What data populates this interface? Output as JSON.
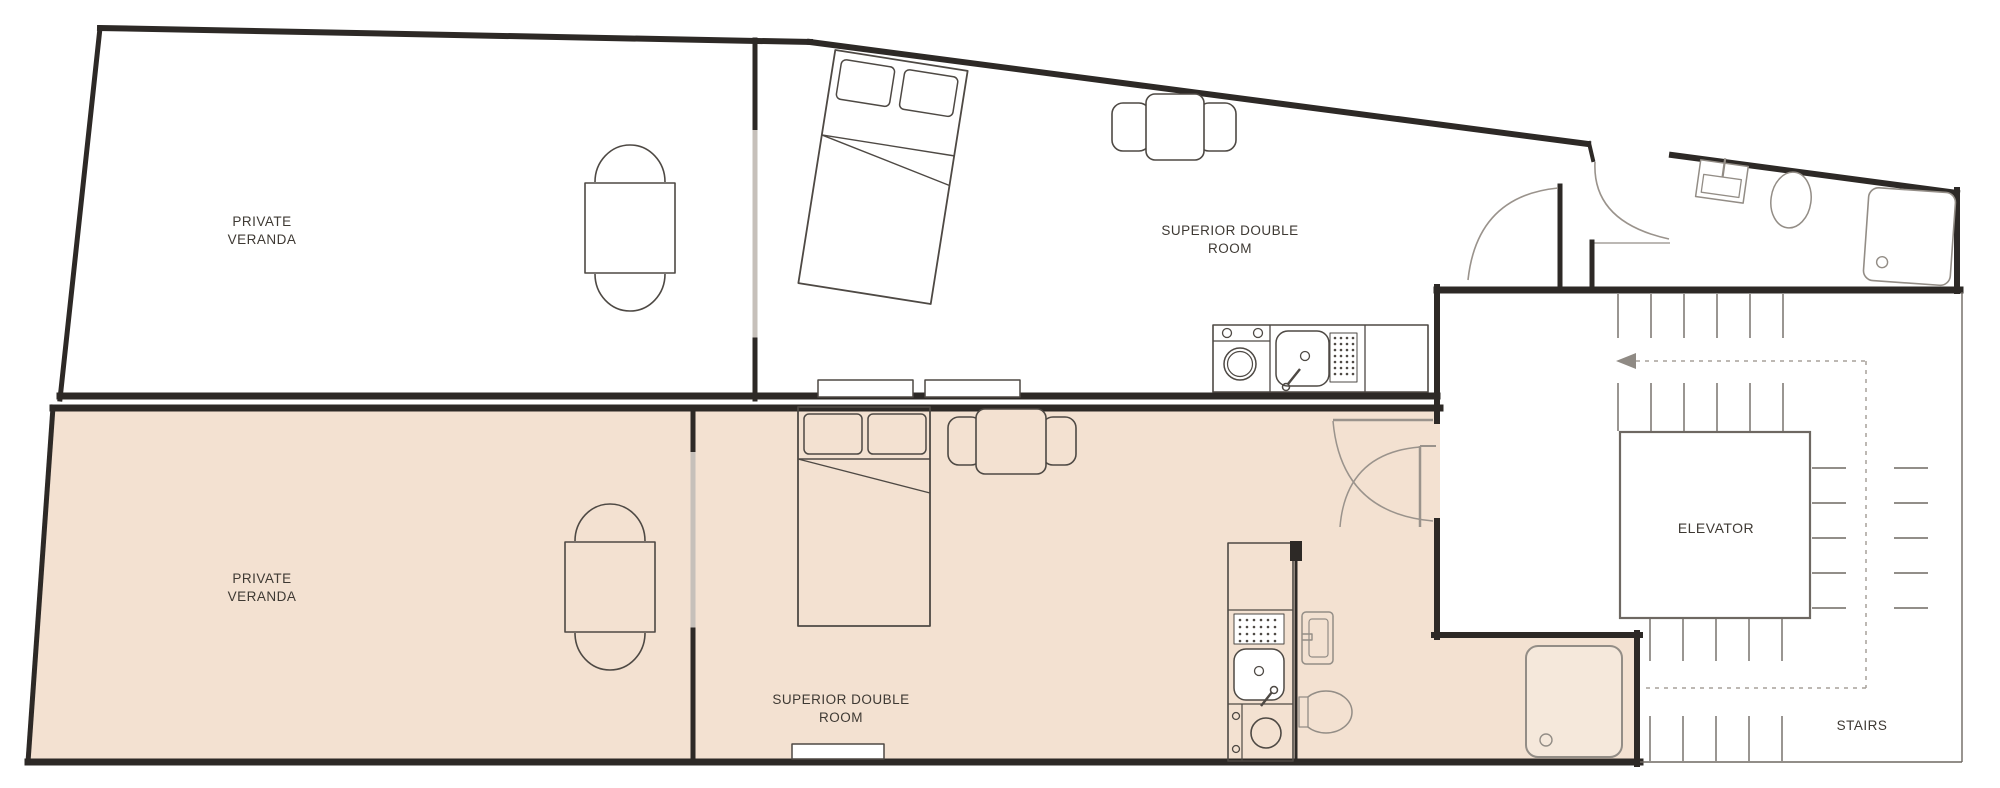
{
  "diagram_type": "hotel floor plan",
  "labels": {
    "veranda_top_line1": "PRIVATE",
    "veranda_top_line2": "VERANDA",
    "veranda_bottom_line1": "PRIVATE",
    "veranda_bottom_line2": "VERANDA",
    "room_top_line1": "SUPERIOR DOUBLE",
    "room_top_line2": "ROOM",
    "room_bottom_line1": "SUPERIOR DOUBLE",
    "room_bottom_line2": "ROOM",
    "elevator": "ELEVATOR",
    "stairs": "STAIRS"
  },
  "colors": {
    "wall": "#2d2926",
    "furn": "#4e4944",
    "fixture": "#938d86",
    "door": "#9a938c",
    "glass": "#c6c0ba",
    "tan": "#f3e1d1",
    "tanlight": "#f5e8db",
    "stair": "#6e6862",
    "dashed": "#a7a19a",
    "text": "#3e3933"
  }
}
